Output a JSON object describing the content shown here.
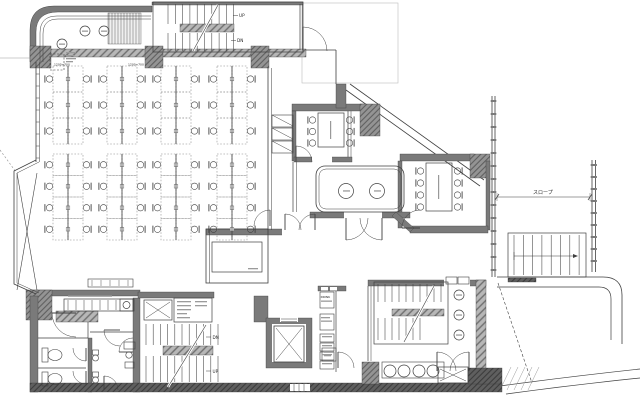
{
  "plan": {
    "title": "office floor plan",
    "stairs": {
      "top": {
        "up": "UP",
        "dn": "DN"
      },
      "west": {
        "dn": "DN",
        "up": "UP"
      }
    },
    "exterior": {
      "ramp_label": "スロープ"
    },
    "vending": {
      "label": "DRINK"
    },
    "office": {
      "desk_note_left": "1200×700",
      "desk_note_right": "1200×700"
    }
  },
  "colors": {
    "wall": "#7a7a7a",
    "column": "#949494",
    "line": "#3f3f3f",
    "background": "#ffffff"
  }
}
